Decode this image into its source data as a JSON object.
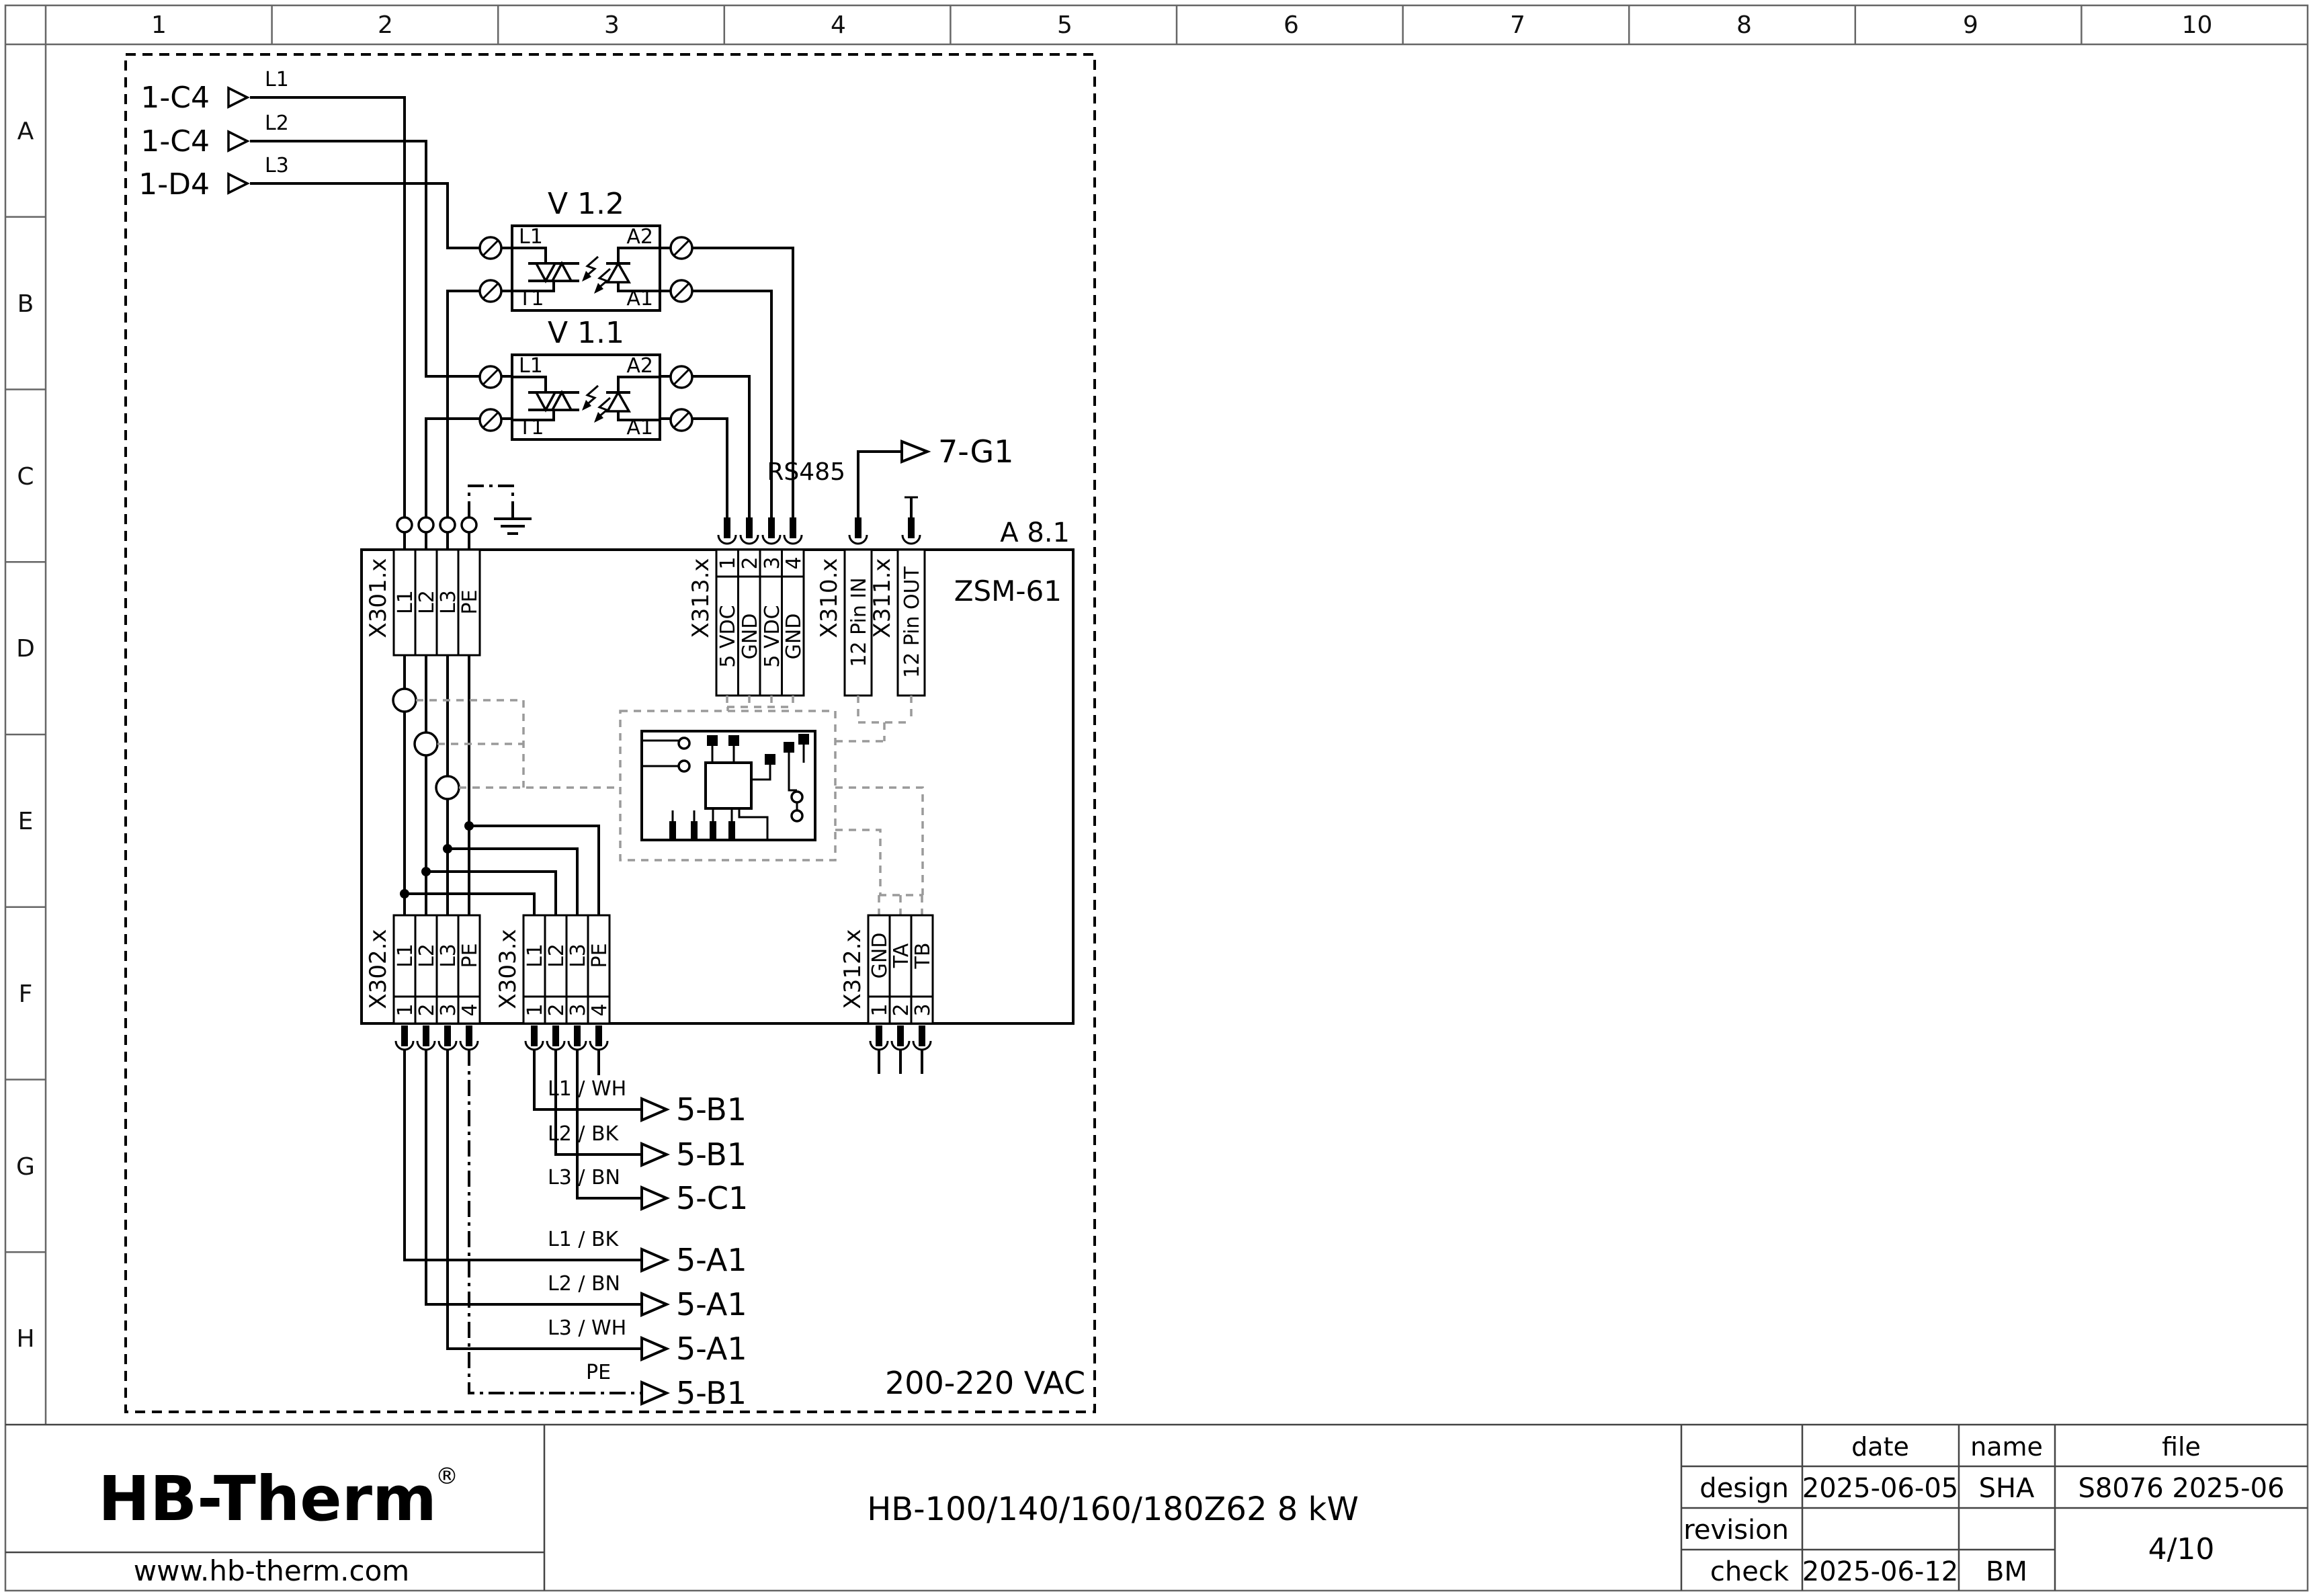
{
  "ruler": {
    "columns": [
      "1",
      "2",
      "3",
      "4",
      "5",
      "6",
      "7",
      "8",
      "9",
      "10"
    ],
    "rows": [
      "A",
      "B",
      "C",
      "D",
      "E",
      "F",
      "G",
      "H"
    ]
  },
  "inputs": [
    {
      "ref": "1-C4",
      "wire": "L1"
    },
    {
      "ref": "1-C4",
      "wire": "L2"
    },
    {
      "ref": "1-D4",
      "wire": "L3"
    }
  ],
  "relays": [
    {
      "title": "V 1.2",
      "left_top": "L1",
      "left_bottom": "T1",
      "right_top": "A2",
      "right_bottom": "A1"
    },
    {
      "title": "V 1.1",
      "left_top": "L1",
      "left_bottom": "T1",
      "right_top": "A2",
      "right_bottom": "A1"
    }
  ],
  "module": {
    "designation": "A 8.1",
    "type": "ZSM-61",
    "voltage": "200-220 VAC",
    "bus_label": "RS485",
    "bus_target": "7-G1"
  },
  "connectors": {
    "x301": {
      "name": "X301.x",
      "pins": [
        "L1",
        "L2",
        "L3",
        "PE"
      ]
    },
    "x313": {
      "name": "X313.x",
      "numbers": [
        "1",
        "2",
        "3",
        "4"
      ],
      "pins": [
        "5 VDC",
        "GND",
        "5 VDC",
        "GND"
      ]
    },
    "x310": {
      "name": "X310.x",
      "pin": "12 Pin IN"
    },
    "x311": {
      "name": "X311.x",
      "pin": "12 Pin OUT"
    },
    "x302": {
      "name": "X302.x",
      "pins": [
        "L1",
        "L2",
        "L3",
        "PE"
      ],
      "numbers": [
        "1",
        "2",
        "3",
        "4"
      ]
    },
    "x303": {
      "name": "X303.x",
      "pins": [
        "L1",
        "L2",
        "L3",
        "PE"
      ],
      "numbers": [
        "1",
        "2",
        "3",
        "4"
      ]
    },
    "x312": {
      "name": "X312.x",
      "pins": [
        "GND",
        "TA",
        "TB"
      ],
      "numbers": [
        "1",
        "2",
        "3"
      ]
    }
  },
  "outputs": {
    "upper": [
      {
        "wire": "L1 / WH",
        "ref": "5-B1"
      },
      {
        "wire": "L2 / BK",
        "ref": "5-B1"
      },
      {
        "wire": "L3 / BN",
        "ref": "5-C1"
      }
    ],
    "lower": [
      {
        "wire": "L1 / BK",
        "ref": "5-A1"
      },
      {
        "wire": "L2 / BN",
        "ref": "5-A1"
      },
      {
        "wire": "L3 / WH",
        "ref": "5-A1"
      },
      {
        "wire": "PE",
        "ref": "5-B1"
      }
    ]
  },
  "title_block": {
    "logo_text": "HB-Therm",
    "registered_mark": "®",
    "logo_color": "#131f3e",
    "website": "www.hb-therm.com",
    "drawing_title": "HB-100/140/160/180Z62 8 kW",
    "col_headers": {
      "date": "date",
      "name": "name",
      "file": "file"
    },
    "design_label": "design",
    "design_date": "2025-06-05",
    "design_name": "SHA",
    "revision_label": "revision",
    "check_label": "check",
    "check_date": "2025-06-12",
    "check_name": "BM",
    "file_value": "S8076 2025-06",
    "page": "4/10"
  }
}
